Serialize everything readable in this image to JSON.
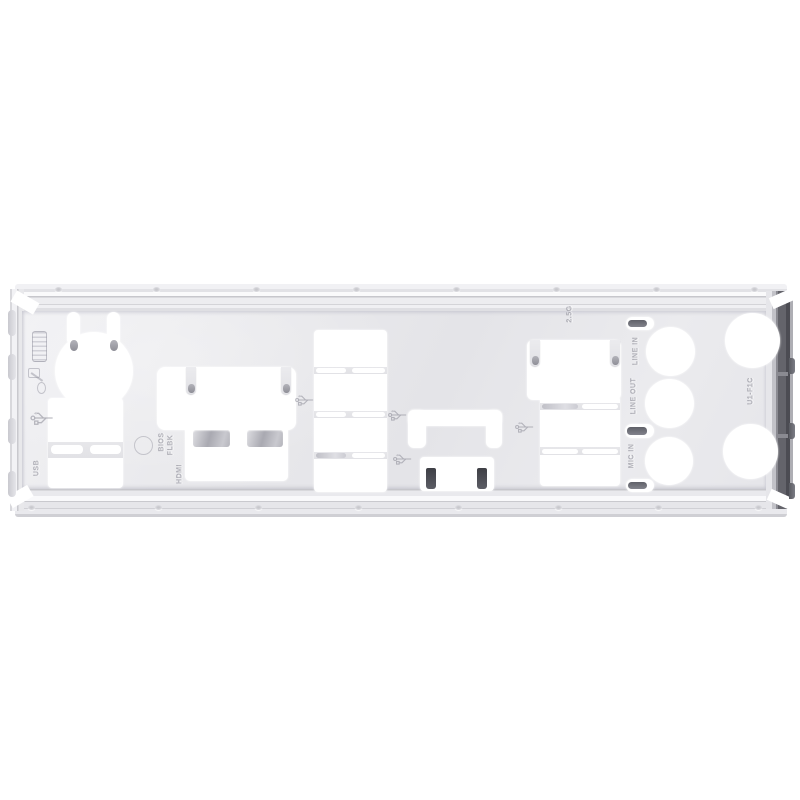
{
  "photo": {
    "subject": "Silver stamped-steel motherboard rear I/O shield plate photographed on a white background",
    "background_color": "#ffffff"
  },
  "colors": {
    "plate_face": "#e9e9ec",
    "ridge_highlight": "#fafafb",
    "ridge_shadow": "#c7c7cc",
    "dark_right_fold": "#53545b",
    "ground_tab": "#45464d",
    "spring_finger": "#6d6e76",
    "emboss_text": "#8c8c96",
    "cutout": "#ffffff"
  },
  "stamps": {
    "lan_speed": "2.5G",
    "audio_labels": [
      "LINE IN",
      "LINE OUT",
      "MIC IN"
    ],
    "hdmi": "HDMI",
    "usb": "USB",
    "bios_line1": "BIOS",
    "bios_line2": "FLBK",
    "part_code": "U1-F1C"
  },
  "icons": [
    "vga-port-icon",
    "keyboard-mouse-icon",
    "usb-trident-icon",
    "bios-button-icon"
  ]
}
